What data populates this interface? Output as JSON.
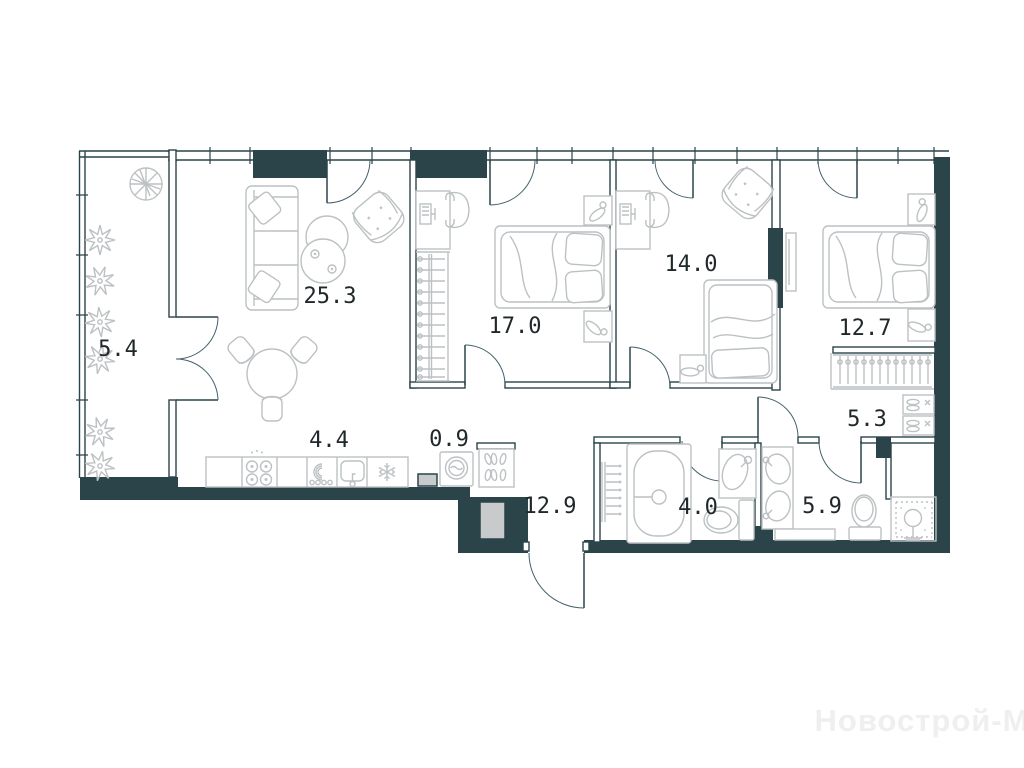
{
  "plan": {
    "watermark": "Новострой-М",
    "colors": {
      "wall": "#2a4449",
      "furniture": "#bcc1c3",
      "label": "#20282a",
      "shaft_fill": "#c8cacb",
      "watermark": "#efefef",
      "background": "#ffffff"
    },
    "rooms": [
      {
        "name": "balcony",
        "area": "5.4"
      },
      {
        "name": "living-room",
        "area": "25.3"
      },
      {
        "name": "bedroom-1",
        "area": "17.0"
      },
      {
        "name": "bedroom-2",
        "area": "14.0"
      },
      {
        "name": "bedroom-3",
        "area": "12.7"
      },
      {
        "name": "kitchen",
        "area": "4.4"
      },
      {
        "name": "utility-niche",
        "area": "0.9"
      },
      {
        "name": "hallway",
        "area": "12.9"
      },
      {
        "name": "wardrobe-hall",
        "area": "5.3"
      },
      {
        "name": "bathroom-1",
        "area": "4.0"
      },
      {
        "name": "bathroom-2",
        "area": "5.9"
      }
    ]
  }
}
